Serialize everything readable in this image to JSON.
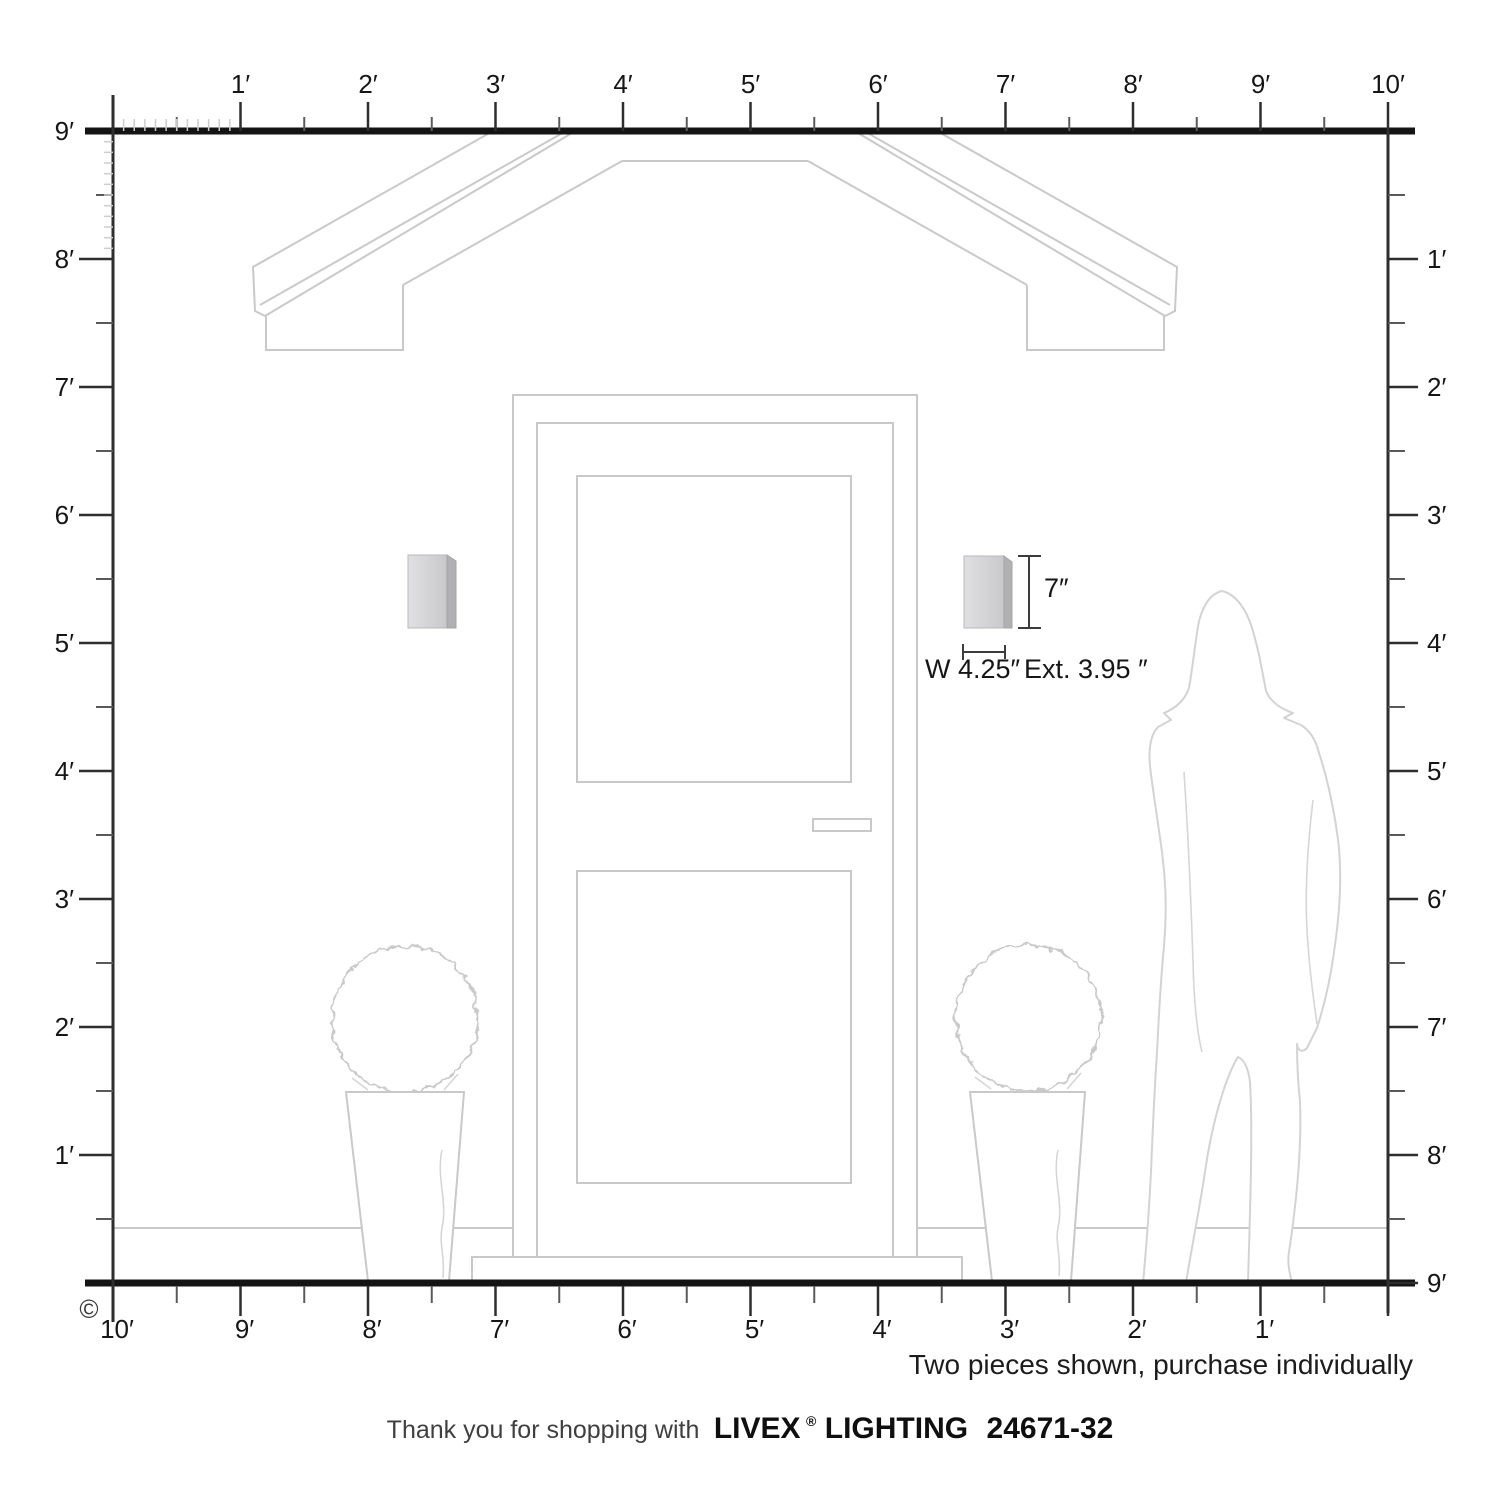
{
  "diagram": {
    "copyright": "©",
    "note": "Two pieces shown, purchase individually",
    "footer": {
      "thanks": "Thank you for shopping with",
      "brand": "LIVEX",
      "registered": "®",
      "brand_suffix": "LIGHTING",
      "model": "24671-32"
    },
    "dimensions": {
      "height": "7″",
      "width": "W 4.25″",
      "extension": "Ext. 3.95 ″"
    },
    "rulers": {
      "top_labels": [
        "1′",
        "2′",
        "3′",
        "4′",
        "5′",
        "6′",
        "7′",
        "8′",
        "9′",
        "10′"
      ],
      "left_labels": [
        "9′",
        "8′",
        "7′",
        "6′",
        "5′",
        "4′",
        "3′",
        "2′",
        "1′"
      ],
      "right_labels": [
        "1′",
        "2′",
        "3′",
        "4′",
        "5′",
        "6′",
        "7′",
        "8′",
        "9′"
      ],
      "bottom_labels": [
        "10′",
        "9′",
        "8′",
        "7′",
        "6′",
        "5′",
        "4′",
        "3′",
        "2′",
        "1′"
      ]
    },
    "colors": {
      "line_gray": "#c9c9c9",
      "ink": "#161616",
      "sconce_face_light": "#e0e0e2",
      "sconce_face_dark": "#c9c9cb",
      "sconce_side": "#b1b1b3"
    }
  }
}
